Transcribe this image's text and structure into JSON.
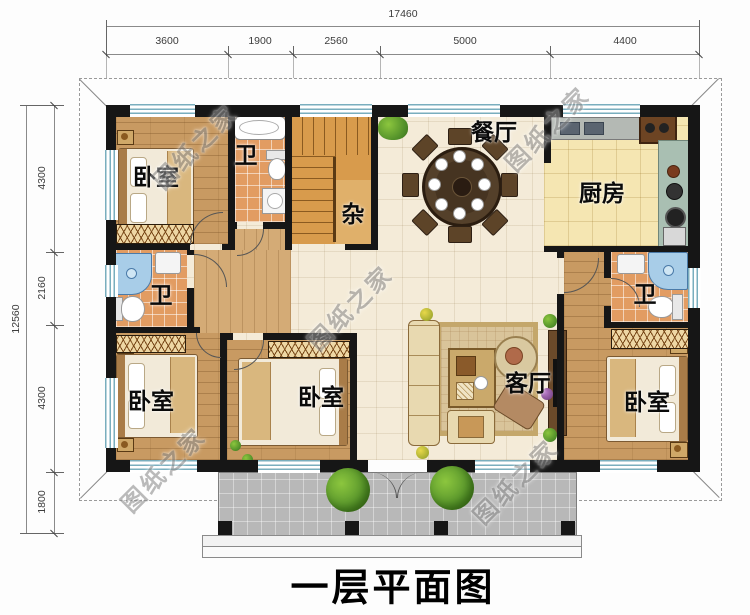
{
  "title": "一层平面图",
  "watermark_text": "图纸之家",
  "dimensions": {
    "top": {
      "total": "17460",
      "segments": [
        "3600",
        "1900",
        "2560",
        "5000",
        "4400"
      ]
    },
    "left": {
      "total": "12560",
      "segments": [
        "4300",
        "2160",
        "4300",
        "1800"
      ]
    }
  },
  "rooms": {
    "bedroom_top_left": {
      "label": "卧室"
    },
    "bath_top": {
      "label": "卫"
    },
    "storage": {
      "label": "杂"
    },
    "dining": {
      "label": "餐厅"
    },
    "kitchen": {
      "label": "厨房"
    },
    "bath_left": {
      "label": "卫"
    },
    "living": {
      "label": "客厅"
    },
    "bath_right": {
      "label": "卫"
    },
    "bedroom_bottom_left": {
      "label": "卧室"
    },
    "bedroom_bottom_middle": {
      "label": "卧室"
    },
    "bedroom_bottom_right": {
      "label": "卧室"
    }
  },
  "colors": {
    "wall": "#161616",
    "wood_floor": "#c89a62",
    "tile_floor": "#f4ebd8",
    "kitchen_floor": "#f5e6b2",
    "bath_floor": "#e29c62",
    "storage_floor": "#dcdcdc",
    "porch_floor": "#b8b8b8",
    "stair": "#d89b4c",
    "window_glass": "#79aebe",
    "shower": "#a8cde8",
    "watermark": "#8f8f8f"
  }
}
